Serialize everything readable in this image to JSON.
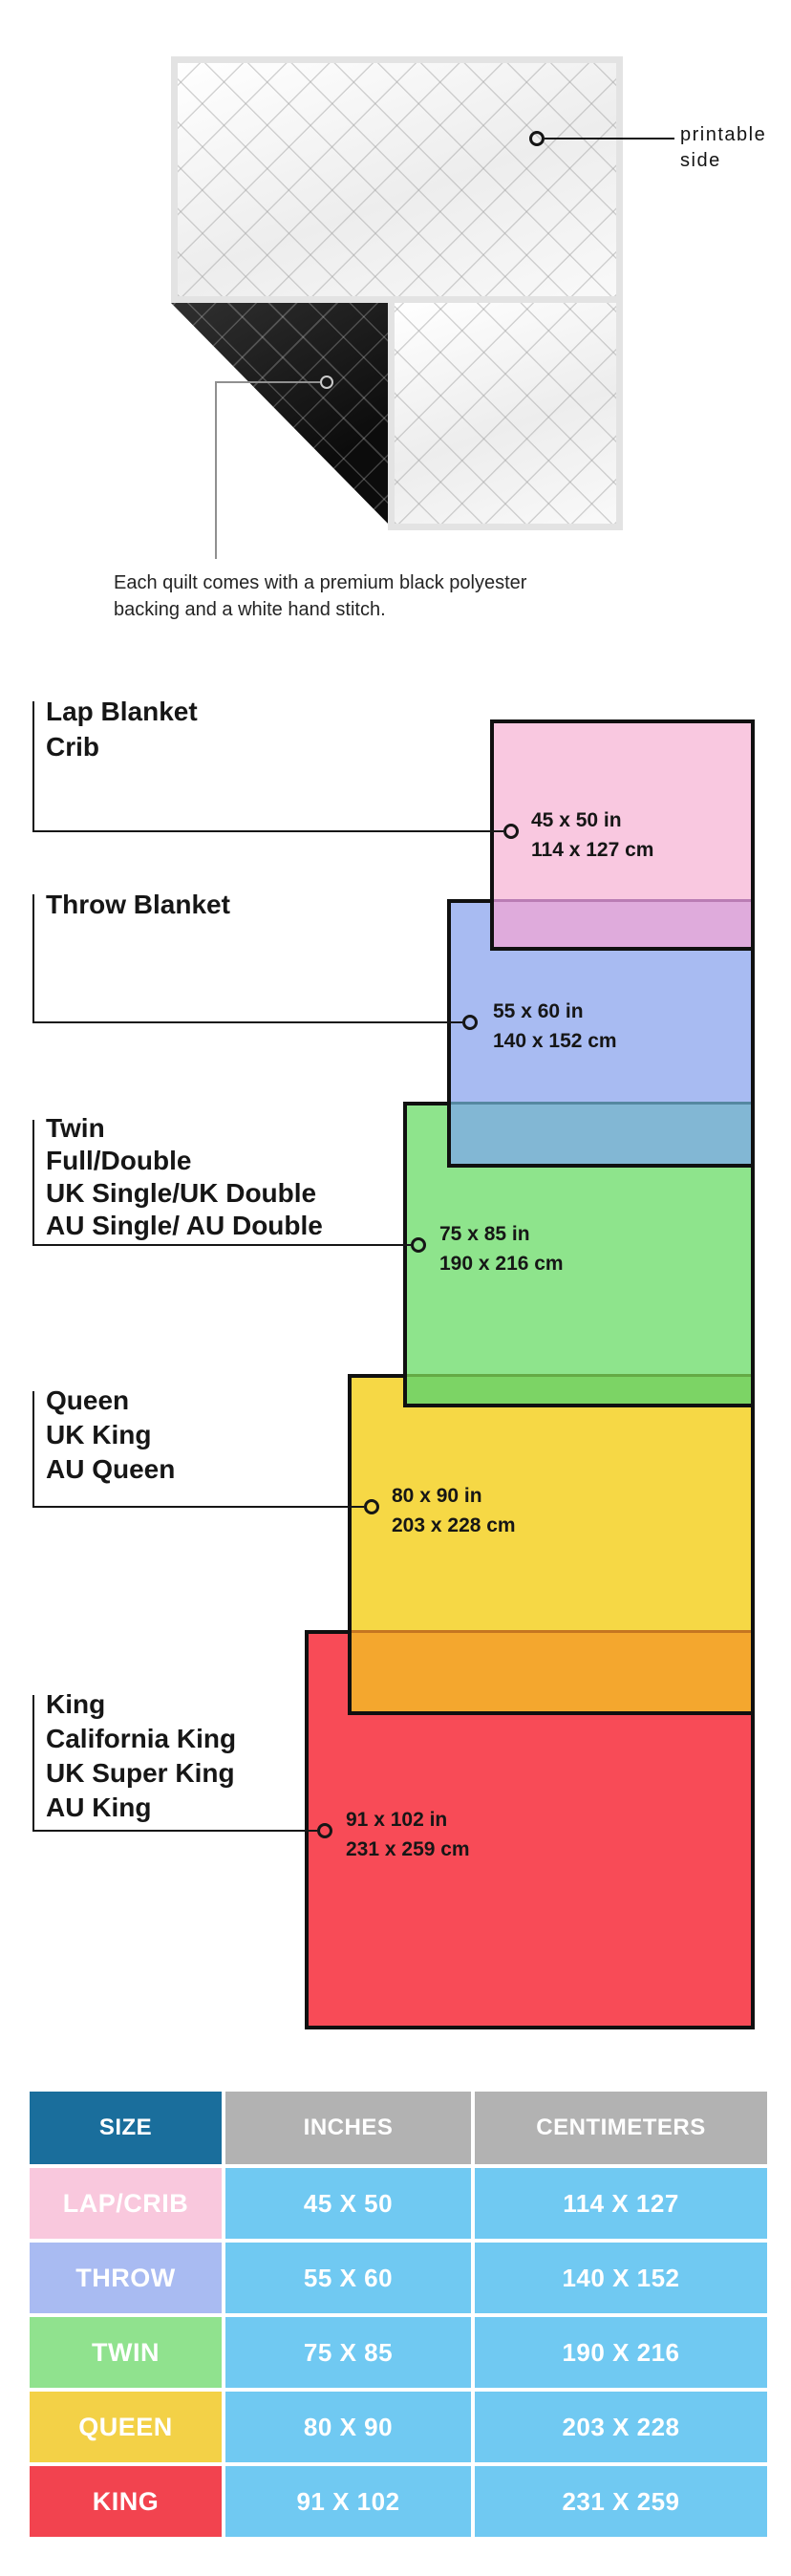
{
  "quilt": {
    "printable_side_lines": [
      "printable",
      "side"
    ],
    "caption_lines": [
      "Each quilt comes with a premium black polyester",
      "backing and a white hand stitch."
    ],
    "front_color": "#f5f5f5",
    "backing_color": "#141414"
  },
  "diagram": {
    "rects": [
      {
        "name": "lap-crib",
        "color": "#f9c8e0",
        "overlap_color": "#dfabdc"
      },
      {
        "name": "throw",
        "color": "#a8bbf2",
        "overlap_color": "#82b7d4"
      },
      {
        "name": "twin",
        "color": "#8ee48c",
        "overlap_color": "#7cd465"
      },
      {
        "name": "queen",
        "color": "#f6d845",
        "overlap_color": "#f4a72e"
      },
      {
        "name": "king",
        "color": "#f84b57"
      }
    ],
    "groups": [
      {
        "labels": [
          "Lap Blanket",
          "Crib"
        ],
        "inches": "45 x 50 in",
        "centimeters": "114 x 127 cm"
      },
      {
        "labels": [
          "Throw Blanket"
        ],
        "inches": "55 x 60 in",
        "centimeters": "140 x 152 cm"
      },
      {
        "labels": [
          "Twin",
          "Full/Double",
          "UK Single/UK Double",
          "AU Single/ AU Double"
        ],
        "inches": "75 x 85 in",
        "centimeters": "190 x 216 cm"
      },
      {
        "labels": [
          "Queen",
          "UK King",
          "AU Queen"
        ],
        "inches": "80 x 90 in",
        "centimeters": "203 x 228 cm"
      },
      {
        "labels": [
          "King",
          "California King",
          "UK Super King",
          "AU King"
        ],
        "inches": "91 x 102 in",
        "centimeters": "231 x 259 cm"
      }
    ]
  },
  "table": {
    "headers": [
      "SIZE",
      "INCHES",
      "CENTIMETERS"
    ],
    "header_size_color": "#1a6e9c",
    "header_gray_color": "#b2b2b2",
    "value_bg_color": "#70c9f2",
    "rows": [
      {
        "size": "LAP/CRIB",
        "inches": "45 X 50",
        "centimeters": "114 X 127",
        "color": "#f9c8dd"
      },
      {
        "size": "THROW",
        "inches": "55 X 60",
        "centimeters": "140 X 152",
        "color": "#a9bbf2"
      },
      {
        "size": "TWIN",
        "inches": "75 X 85",
        "centimeters": "190 X 216",
        "color": "#90e28e"
      },
      {
        "size": "QUEEN",
        "inches": "80 X 90",
        "centimeters": "203 X 228",
        "color": "#f3d147"
      },
      {
        "size": "KING",
        "inches": "91 X 102",
        "centimeters": "231 X 259",
        "color": "#f2434f"
      }
    ]
  }
}
